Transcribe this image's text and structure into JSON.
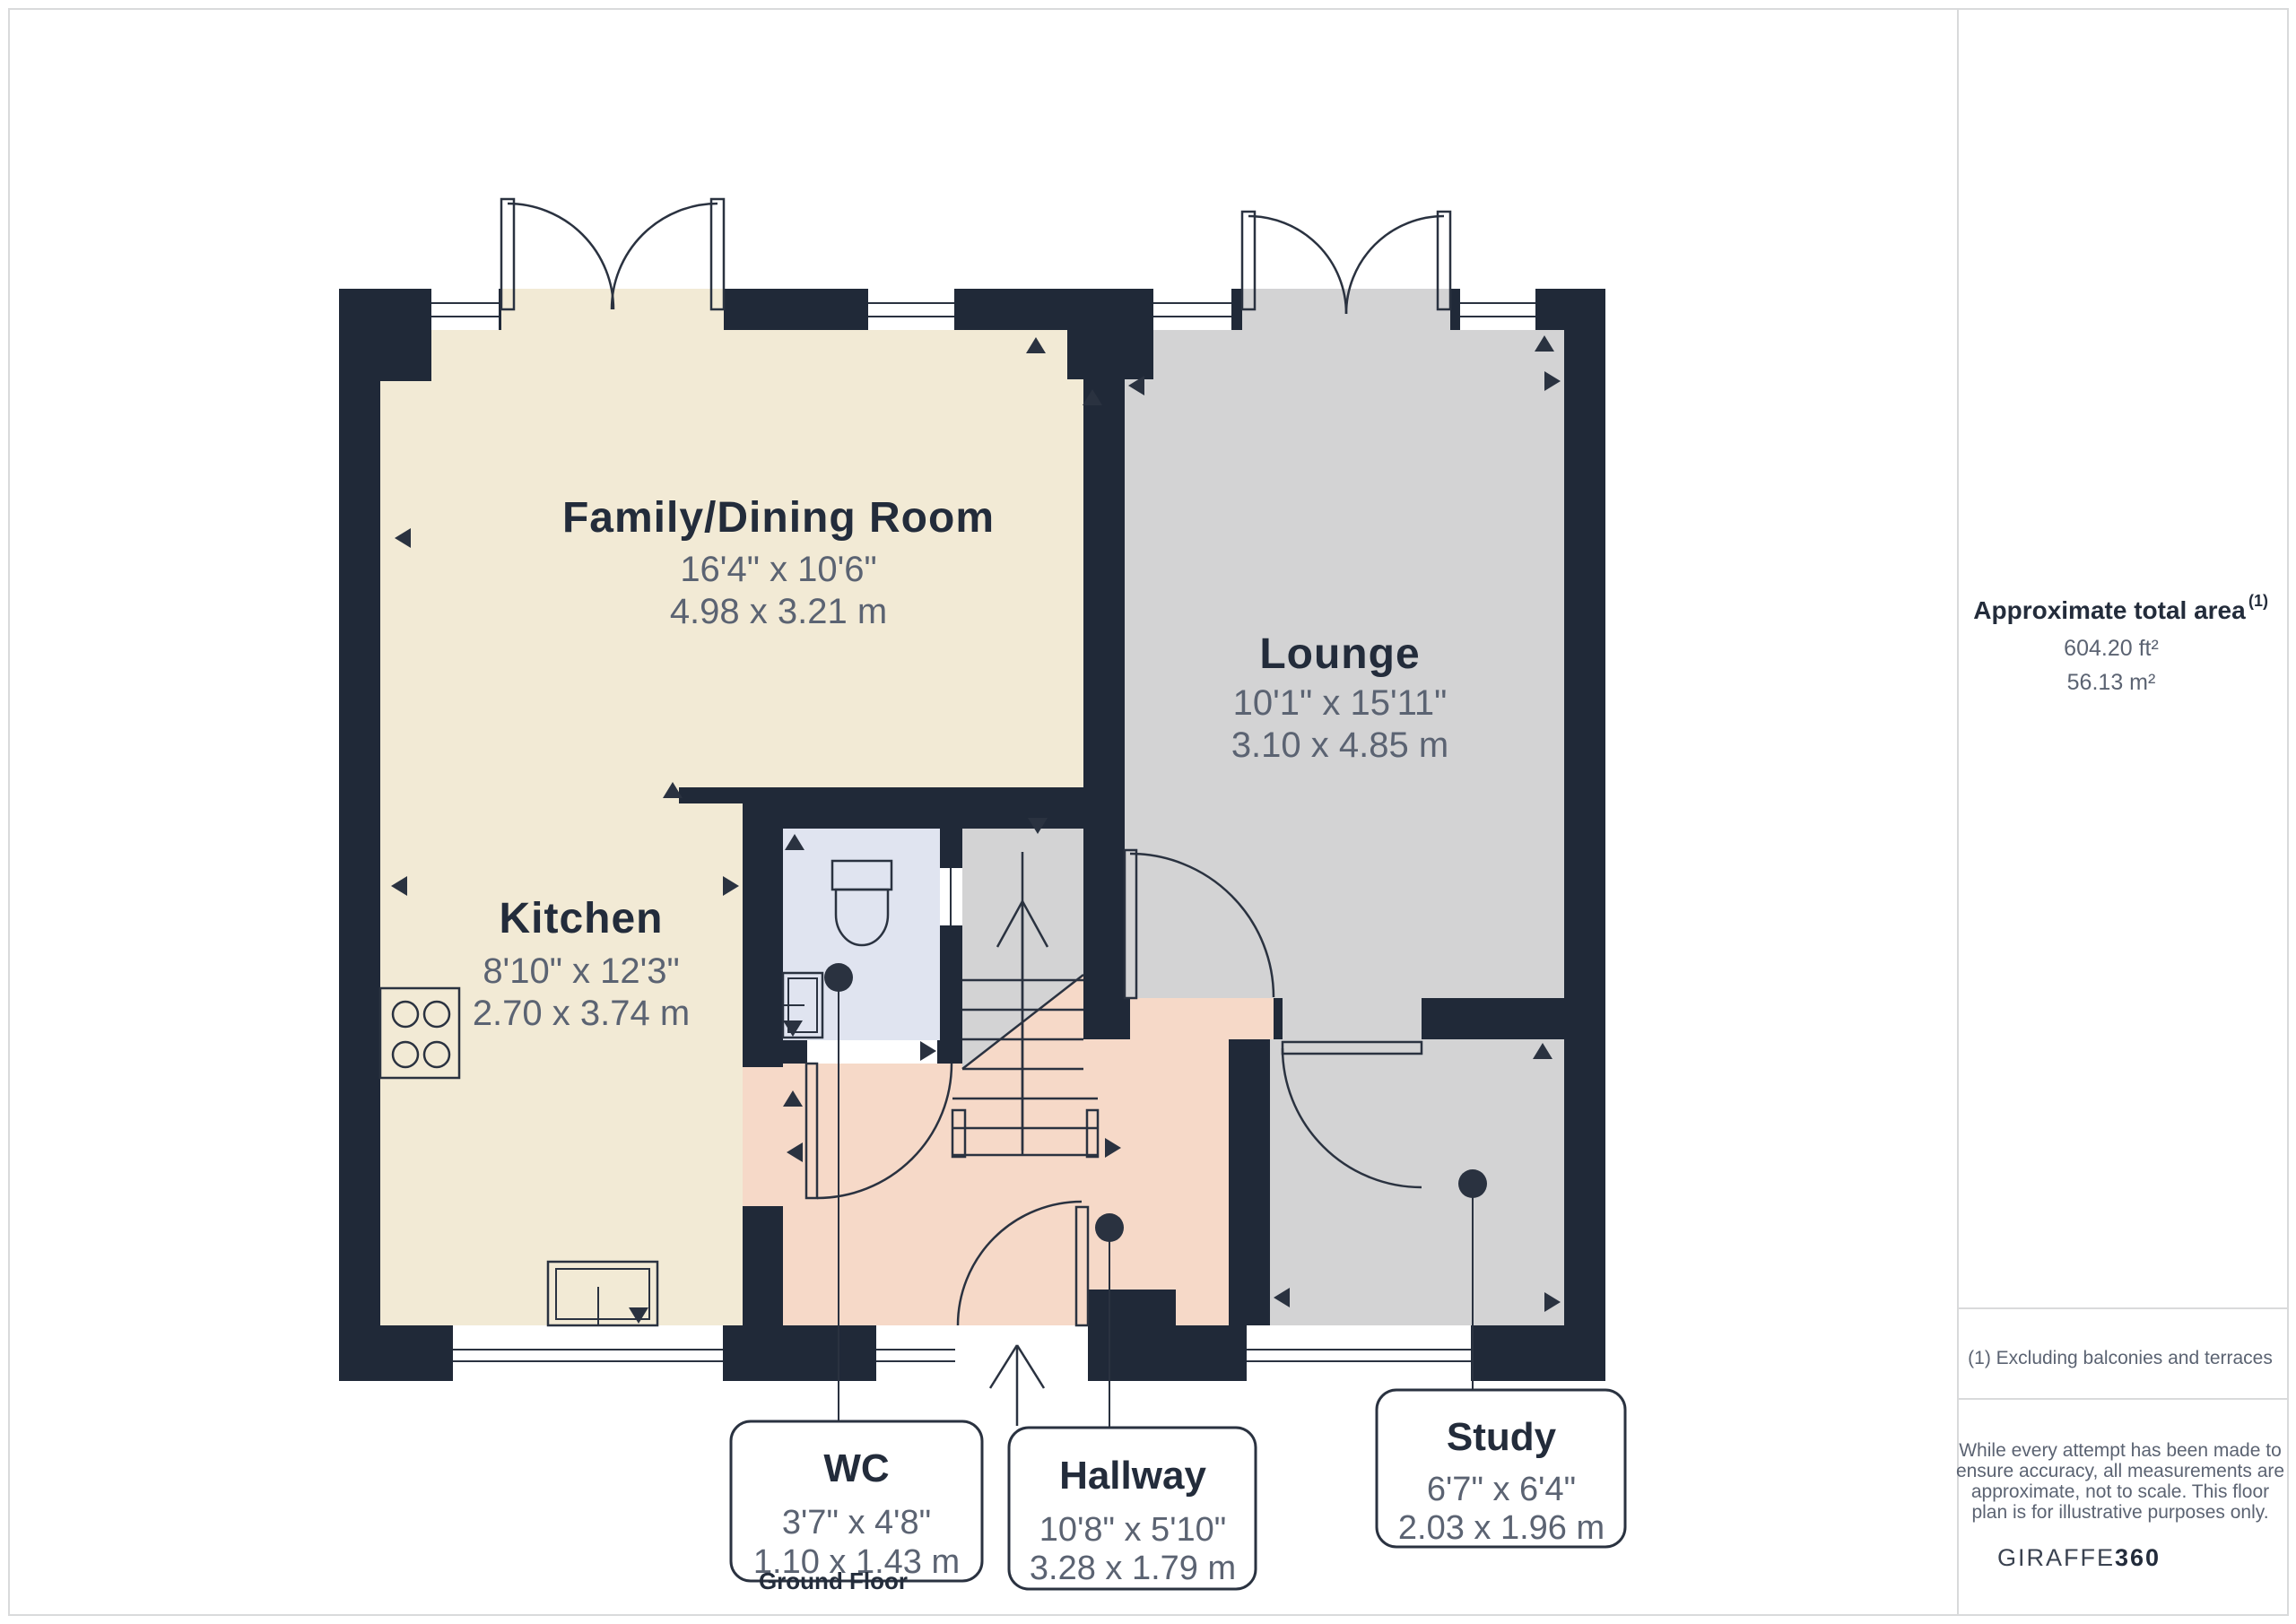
{
  "page": {
    "floor_label": "Ground Floor"
  },
  "rooms": {
    "family_dining": {
      "name": "Family/Dining Room",
      "imperial": "16'4\" x 10'6\"",
      "metric": "4.98 x 3.21 m"
    },
    "lounge": {
      "name": "Lounge",
      "imperial": "10'1\" x 15'11\"",
      "metric": "3.10 x 4.85 m"
    },
    "kitchen": {
      "name": "Kitchen",
      "imperial": "8'10\" x 12'3\"",
      "metric": "2.70 x 3.74 m"
    },
    "wc": {
      "name": "WC",
      "imperial": "3'7\" x 4'8\"",
      "metric": "1.10 x 1.43 m"
    },
    "hallway": {
      "name": "Hallway",
      "imperial": "10'8\" x 5'10\"",
      "metric": "3.28 x 1.79 m"
    },
    "study": {
      "name": "Study",
      "imperial": "6'7\" x 6'4\"",
      "metric": "2.03 x 1.96 m"
    }
  },
  "sidebar": {
    "area_title": "Approximate total area",
    "area_footnote_marker": "(1)",
    "area_imperial": "604.20 ft²",
    "area_metric": "56.13 m²",
    "footnote": "(1) Excluding balconies and terraces",
    "disclaimer_lines": [
      "While every attempt has been made to",
      "ensure accuracy, all measurements are",
      "approximate, not to scale. This floor",
      "plan is for illustrative purposes only."
    ],
    "brand_name_regular": "GIRAFFE",
    "brand_name_bold": "360"
  },
  "colors": {
    "wall": "#202938",
    "room_cream": "#f2ead5",
    "room_gray": "#d3d3d4",
    "room_pink": "#f6d9c8",
    "room_blue": "#e0e4f0",
    "text_dark": "#232c3b",
    "text_dim": "#5b6372",
    "line": "#2a3240",
    "frame": "#d9dadb"
  }
}
